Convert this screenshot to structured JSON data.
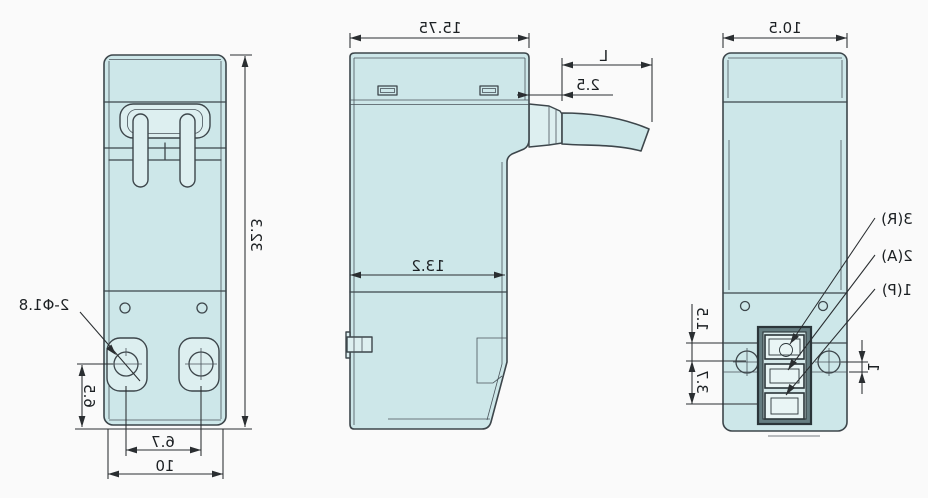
{
  "drawing": {
    "description": "Mirrored three-view dimension drawing of a compact 3-port valve",
    "colors": {
      "background": "#fafafa",
      "body_fill": "#cde7e9",
      "body_light": "#ddeff0",
      "outline": "#3d464b",
      "dimension": "#2a2e31",
      "terminal_dark": "#657d81",
      "terminal_light": "#d4e8e9"
    },
    "front_view": {
      "hole_callout": "2-Φ1.8",
      "dim_height": "32.3",
      "dim_hole_offset": "6.5",
      "dim_hole_spacing": "6.7",
      "dim_width": "10"
    },
    "side_view": {
      "dim_width": "15.75",
      "dim_cable_offset": "2.5",
      "dim_cable_length": "L",
      "dim_lower_width": "13.2"
    },
    "back_view": {
      "dim_width": "10.5",
      "dim_step": "1.5",
      "dim_pitch": "3.7",
      "dim_edge": "1",
      "ports": [
        {
          "label": "3(R)"
        },
        {
          "label": "2(A)"
        },
        {
          "label": "1(P)"
        }
      ]
    }
  }
}
